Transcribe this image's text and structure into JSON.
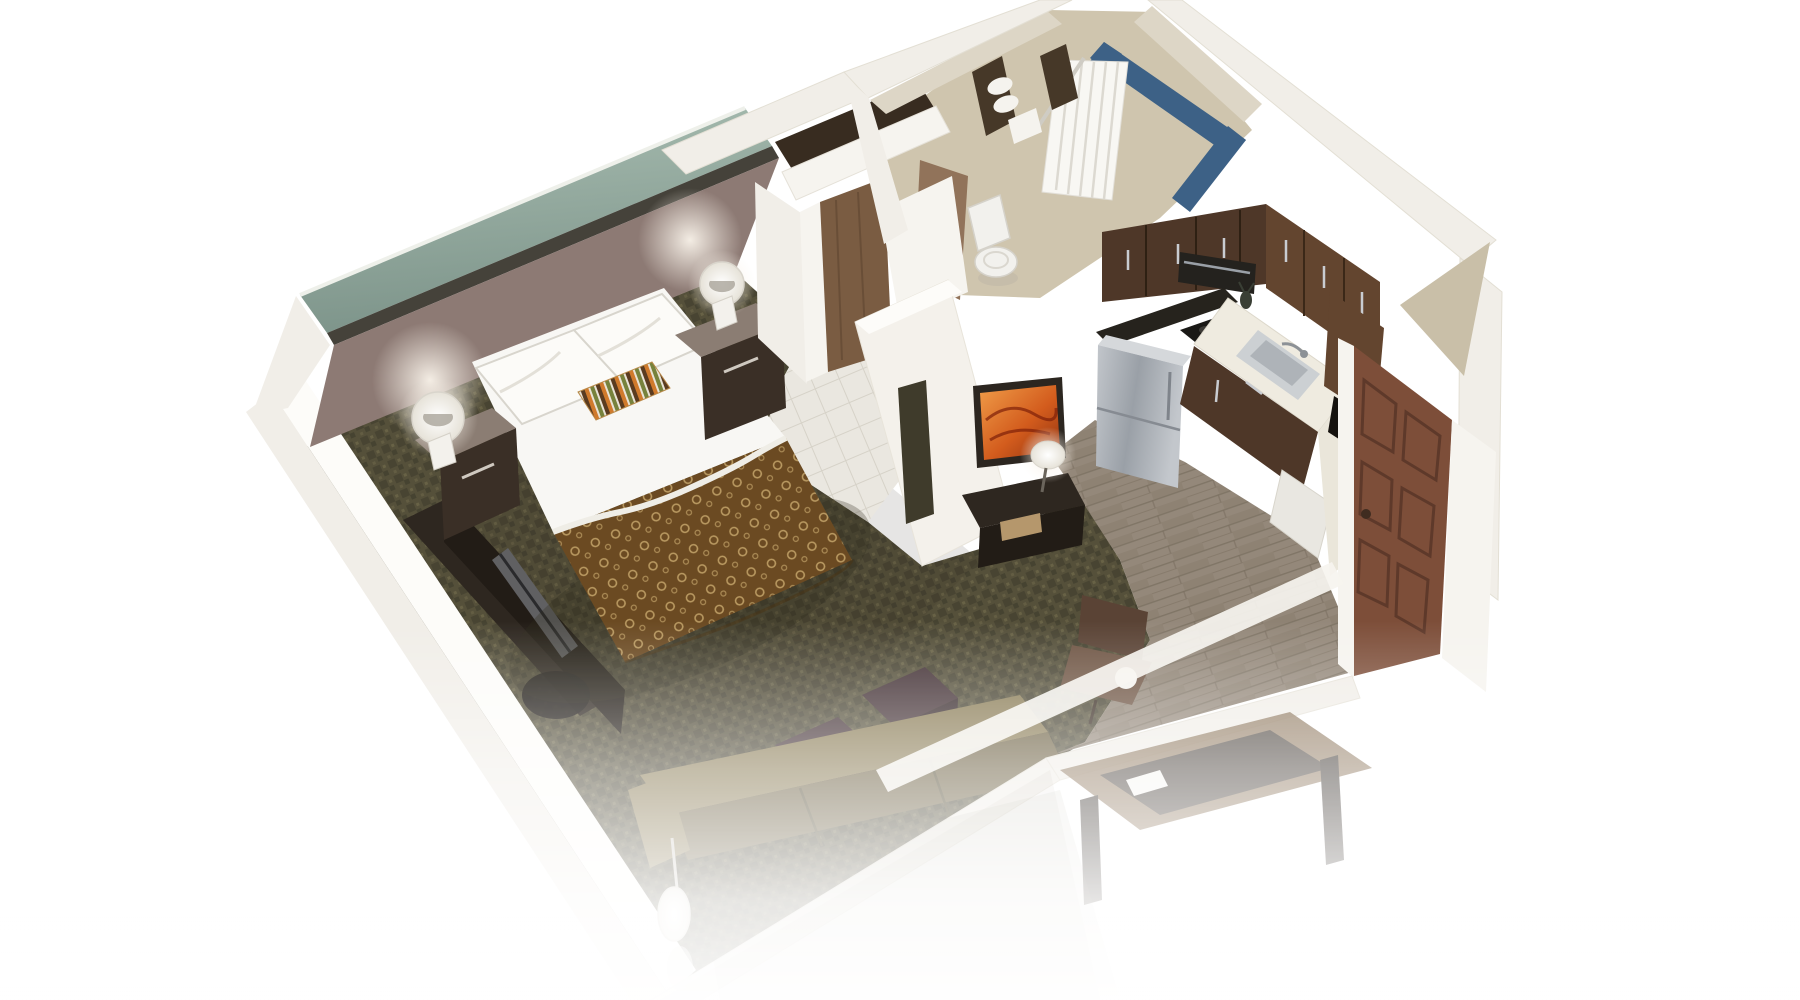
{
  "meta": {
    "title": "3D isometric cutaway floor plan rendering of a studio hotel suite",
    "canvas": {
      "width": 1800,
      "height": 1000
    },
    "style": "photoreal 3D dollhouse view on white background, bottom edge fades to white"
  },
  "scene": {
    "rooms": [
      {
        "name": "bedroom-living",
        "floor": "dark patterned carpet",
        "accent_wall": "sage-teal band over mauve headboard wall"
      },
      {
        "name": "closet",
        "features": [
          "wood sliding doors"
        ]
      },
      {
        "name": "bathroom",
        "features": [
          "bathtub with blue tile surround",
          "white shower curtain",
          "dark towel shelf with white towels",
          "toilet"
        ]
      },
      {
        "name": "kitchen",
        "floor": "gray-brown wood planks",
        "features": [
          "dark walnut upper cabinets",
          "black counter",
          "white counter with steel sink",
          "stainless refrigerator",
          "microwave",
          "cooktop",
          "dishwasher"
        ]
      },
      {
        "name": "entry",
        "features": [
          "paneled wood entry door"
        ]
      }
    ],
    "furniture": [
      "queen bed with white linens, striped accent pillow and brown patterned throw",
      "two espresso nightstands with white orb lamps",
      "media console with TV along left wall",
      "partition wall with orange abstract art, niche, console and small lamp",
      "two dark cube ottomans",
      "olive sofa along bottom wall",
      "brown office chair",
      "ghosted table with papers outside fade line",
      "white floor lamp"
    ]
  },
  "colors": {
    "background": "#ffffff",
    "wallBand": "#f1eee8",
    "wallWhite": "#f6f4ef",
    "wallBright": "#fdfcf9",
    "tealLight": "#a9beb2",
    "tealDark": "#7d948a",
    "railDark": "#45423a",
    "headboardWall": "#8d7a74",
    "carpetBase": "#55503a",
    "carpetDark": "#3b382a",
    "carpetLight": "#716a4c",
    "tileWhite": "#eae7e0",
    "tileLine": "#d6d2c8",
    "bathFloor": "#cfc5ae",
    "bathWall": "#ddd6c6",
    "tubBlue": "#3d6186",
    "curtainWhite": "#f8f7f3",
    "towelDark": "#463828",
    "towelWhite": "#f5f3ee",
    "toiletWhite": "#f2f1ed",
    "woodFloor": "#94887a",
    "woodLine": "#7b7061",
    "closetDark": "#382c20",
    "closetDoor": "#7a5c42",
    "closetDoorLight": "#91735a",
    "partitionWhite": "#f4f1eb",
    "nicheDark": "#3f3b2b",
    "artFrame": "#2c2620",
    "artOrangeA": "#f09d49",
    "artOrangeB": "#d35c1d",
    "artOrangeC": "#8e3110",
    "consoleDark": "#2e2720",
    "consoleDarker": "#221c16",
    "drawerWood": "#b5976c",
    "nightstand": "#3a2f26",
    "nightstandTop": "#8b7d73",
    "lampWhite": "#fbfaf6",
    "tvGray": "#606062",
    "spreadBrown": "#6b4a22",
    "spreadRing": "#c7a76c",
    "bedWhite": "#f8f7f4",
    "pillowWhite": "#fcfbf8",
    "stripeOrange": "#d07a2c",
    "stripeGreen": "#77823c",
    "stripeBrown": "#5a3b20",
    "stripeCream": "#e9e3d6",
    "cabinetDark": "#4e3728",
    "cabinetMid": "#63452f",
    "counterBlack": "#26231d",
    "counterWhite": "#efebe0",
    "steel": "#c3c7cc",
    "steelDark": "#9aa0a7",
    "sinkSteel": "#ccd0d3",
    "dishWhite": "#e9e7e1",
    "doorBrown": "#7d4e39",
    "doorDark": "#5e392a",
    "ottoman": "#443236",
    "sofaOlive": "#8a7c55",
    "sofaOliveDark": "#6e6244",
    "chairBrown": "#5a4335",
    "chairLight": "#6f5544",
    "tableWood": "#8a7257",
    "tableDark": "#3a322b",
    "ghost": "#7a7058"
  }
}
